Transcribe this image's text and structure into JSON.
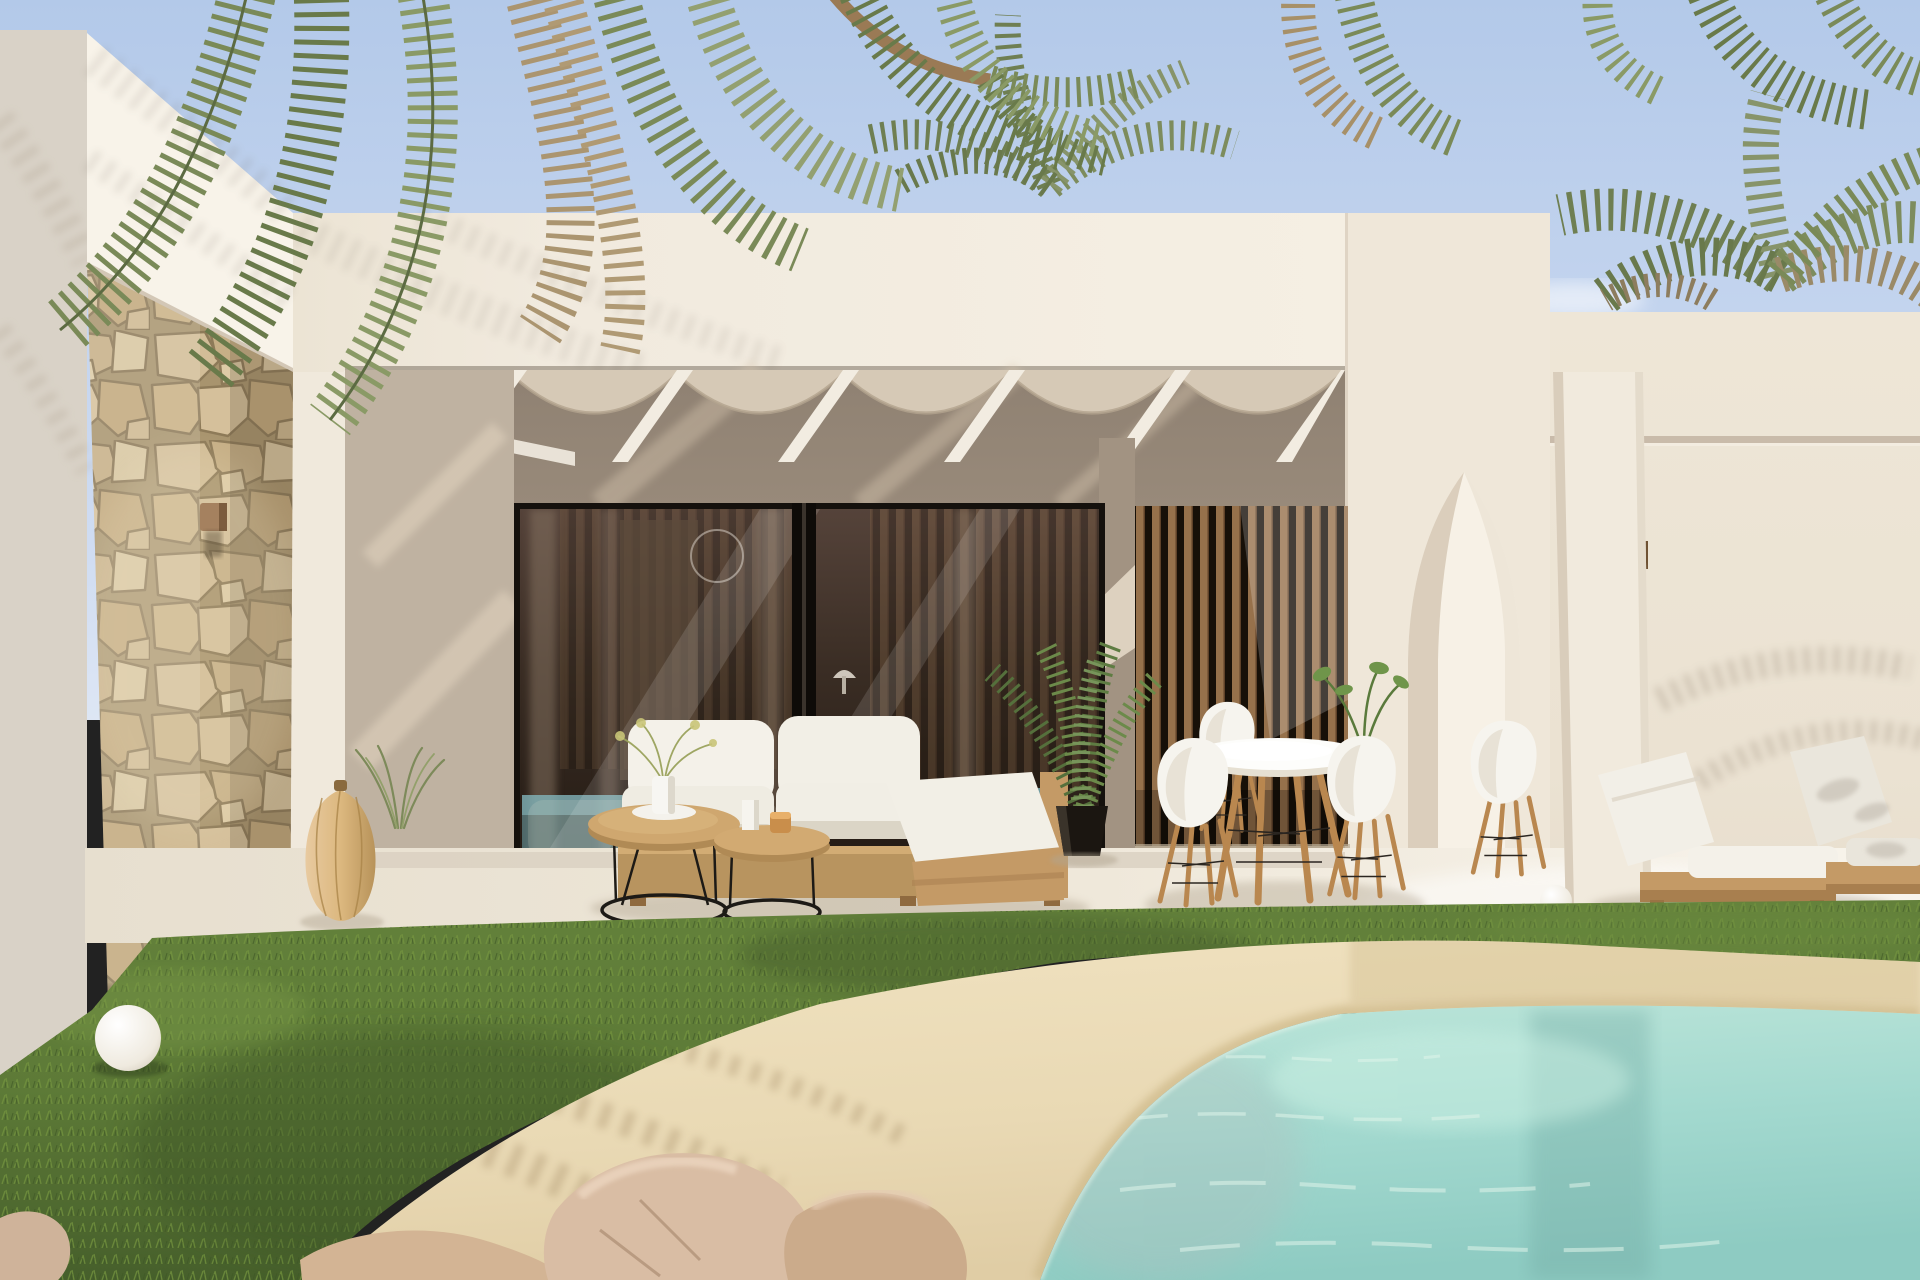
{
  "scene": {
    "type": "photorealistic-architectural-render",
    "subject": "Modern Mediterranean villa exterior with covered terrace, stone accent wall, outdoor lounge and dining furniture, palm trees, lawn and beach-entry pool",
    "time_of_day": "sunny midday",
    "elements": [
      "blue sky",
      "overhanging palm fronds",
      "palm crown behind right wing",
      "white parapet walls",
      "natural stone clad pier",
      "bronze wall lamp",
      "pergola with white rafters and canvas swags",
      "black framed sliding glass doors",
      "interior reflection with fireplace and clock",
      "vertical wood slat screen",
      "pointed arch opening",
      "white column",
      "wood wall sconce",
      "outdoor sofa with white cushions",
      "chaise pad on wood base",
      "two nesting coffee tables with black wire bases",
      "vase with sprigs",
      "candles",
      "rattan lantern",
      "ornamental grass",
      "potted areca palm",
      "round white dining table",
      "four white shell chairs with wood legs",
      "table plant",
      "two wooden sun loungers with white pads",
      "white sphere lamps",
      "green lawn",
      "sandy beach-entry pool edge",
      "turquoise pool water",
      "beige rocks"
    ]
  },
  "palette": {
    "sky_top": "#b3c9e9",
    "sky_low": "#cfdcf2",
    "wall_bright": "#f8f3e9",
    "wall_cream": "#f1eade",
    "wall_right": "#ebe2d2",
    "wall_shadow": "#9a8b7b",
    "stone_base": "#a8946e",
    "stone_light": "#d5c29c",
    "wood": "#c49a66",
    "wood_dark": "#a87f4f",
    "slat_wood": "#96714b",
    "glass_dark": "#2e241c",
    "frame_black": "#15110d",
    "cushion_white": "#f4f1e9",
    "grass_green": "#5d7a37",
    "sand": "#e9d9b4",
    "water": "#a3d9cf",
    "terrace": "#efe8da",
    "palm_green": "#7a8a58",
    "palm_dry": "#ab9570"
  }
}
